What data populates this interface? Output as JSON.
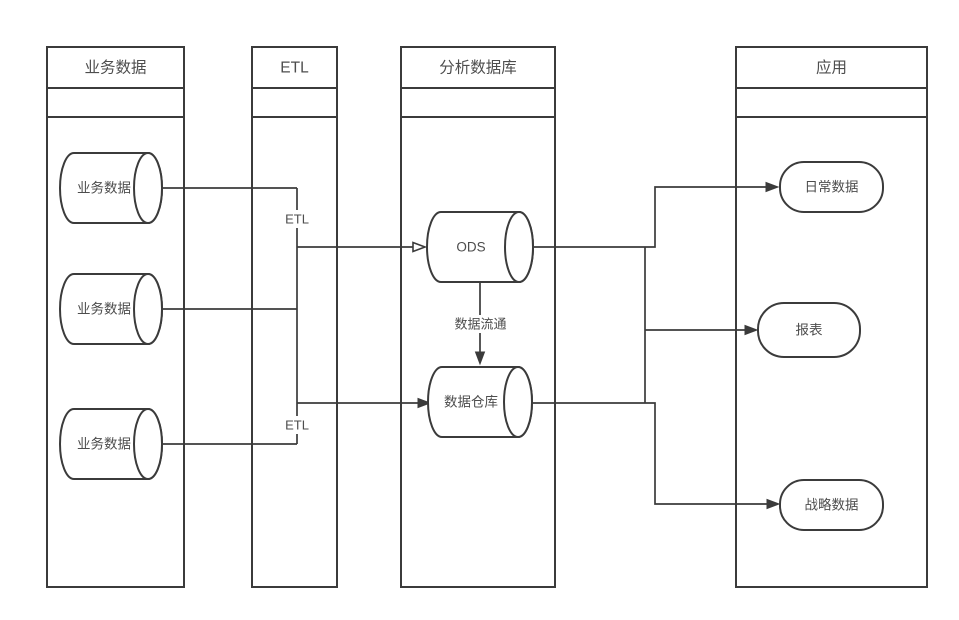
{
  "diagram": {
    "lanes": [
      {
        "title": "业务数据"
      },
      {
        "title": "ETL"
      },
      {
        "title": "分析数据库"
      },
      {
        "title": "应用"
      }
    ],
    "nodes": {
      "biz1": {
        "label": "业务数据",
        "shape": "cylinder"
      },
      "biz2": {
        "label": "业务数据",
        "shape": "cylinder"
      },
      "biz3": {
        "label": "业务数据",
        "shape": "cylinder"
      },
      "ods": {
        "label": "ODS",
        "shape": "cylinder"
      },
      "warehouse": {
        "label": "数据仓库",
        "shape": "cylinder"
      },
      "daily": {
        "label": "日常数据",
        "shape": "rounded-rect"
      },
      "report": {
        "label": "报表",
        "shape": "rounded-rect"
      },
      "strategy": {
        "label": "战略数据",
        "shape": "rounded-rect"
      }
    },
    "edge_labels": {
      "etl_top": "ETL",
      "etl_bottom": "ETL",
      "flow": "数据流通"
    },
    "colors": {
      "stroke": "#3b3b3b",
      "text": "#4d4d4d",
      "background": "#ffffff"
    }
  }
}
